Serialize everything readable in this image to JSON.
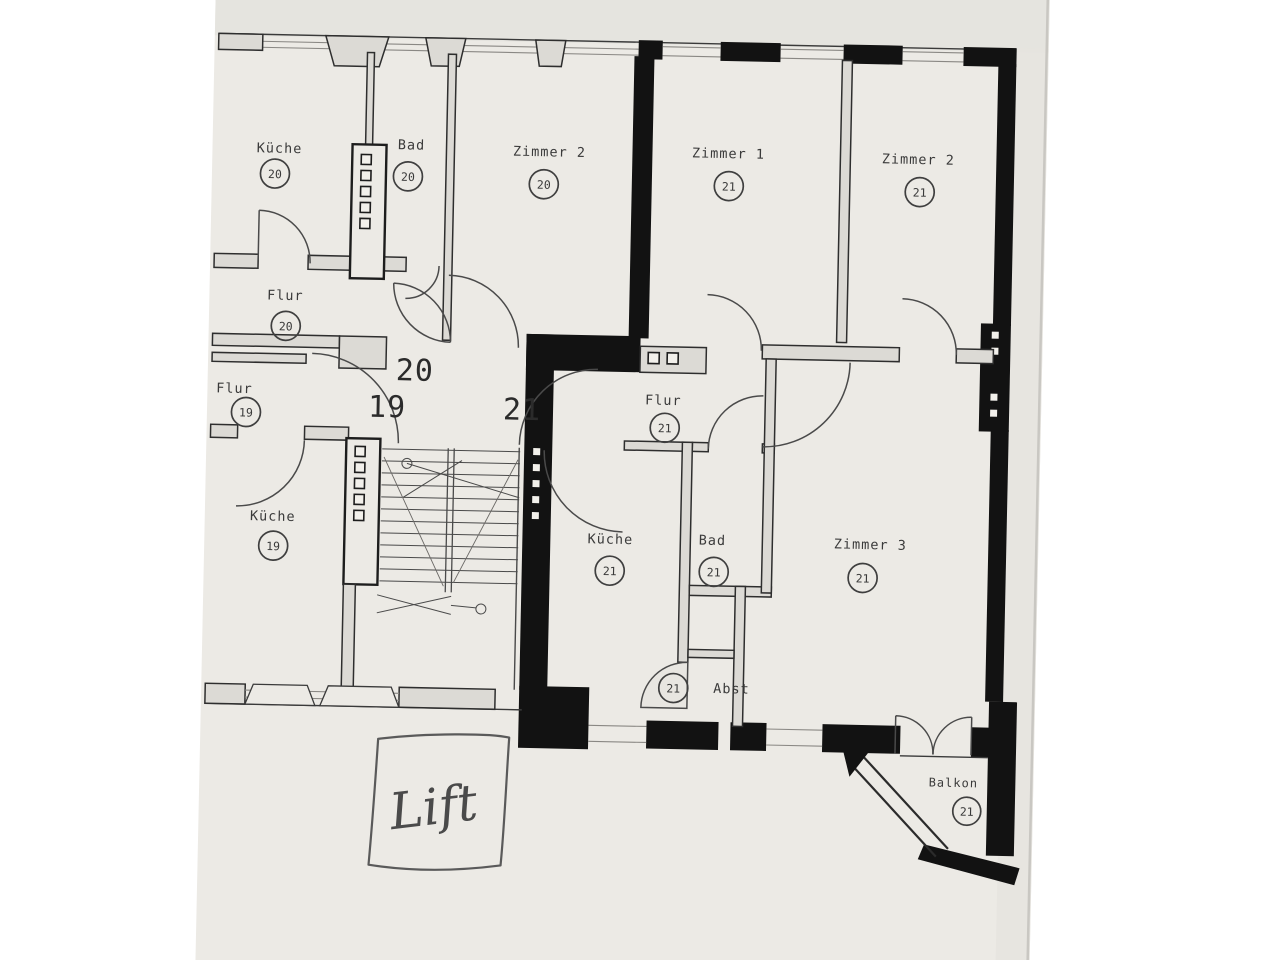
{
  "document": {
    "kind": "scanned floor plan",
    "language": "de"
  },
  "colors": {
    "background": "#ffffff",
    "paper": "#eceae5",
    "wall_black": "#121212",
    "wall_light": "#dcdad5",
    "ink": "#3a3a3a"
  },
  "landing": {
    "numbers": [
      "20",
      "19",
      "21"
    ]
  },
  "rooms": {
    "kueche20": {
      "name": "Küche",
      "unit": "20"
    },
    "bad20": {
      "name": "Bad",
      "unit": "20"
    },
    "zimmer2_20": {
      "name": "Zimmer 2",
      "unit": "20"
    },
    "flur20": {
      "name": "Flur",
      "unit": "20"
    },
    "zimmer1_21": {
      "name": "Zimmer 1",
      "unit": "21"
    },
    "zimmer2_21": {
      "name": "Zimmer 2",
      "unit": "21"
    },
    "flur19": {
      "name": "Flur",
      "unit": "19"
    },
    "kueche19": {
      "name": "Küche",
      "unit": "19"
    },
    "flur21": {
      "name": "Flur",
      "unit": "21"
    },
    "kueche21": {
      "name": "Küche",
      "unit": "21"
    },
    "bad21": {
      "name": "Bad",
      "unit": "21"
    },
    "zimmer3_21": {
      "name": "Zimmer 3",
      "unit": "21"
    },
    "abst21": {
      "name": "Abst",
      "unit": "21"
    },
    "balkon21": {
      "name": "Balkon",
      "unit": "21"
    }
  },
  "annotations": {
    "lift": "Lift"
  }
}
